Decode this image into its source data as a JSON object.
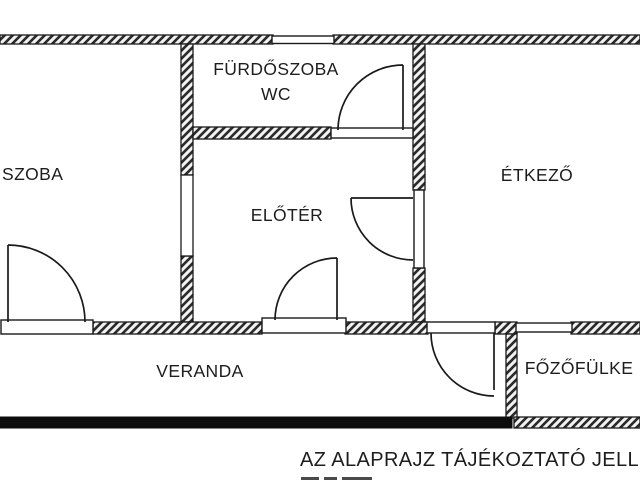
{
  "title": "floor-plan",
  "rooms": {
    "furdoszoba": {
      "line1": "FÜRDŐSZOBA",
      "line2": "WC"
    },
    "szoba": {
      "label": "SZOBA"
    },
    "eloter": {
      "label": "ELŐTÉR"
    },
    "etkezo": {
      "label": "ÉTKEZŐ"
    },
    "veranda": {
      "label": "VERANDA"
    },
    "fozofulke": {
      "label": "FŐZŐFÜLKE"
    }
  },
  "footer": {
    "disclaimer": "AZ ALAPRAJZ TÁJÉKOZTATÓ JELLEGŰ"
  },
  "colors": {
    "wall_line": "#1a1a1a",
    "background": "#ffffff",
    "veranda_wall": "#0d0d0d"
  }
}
